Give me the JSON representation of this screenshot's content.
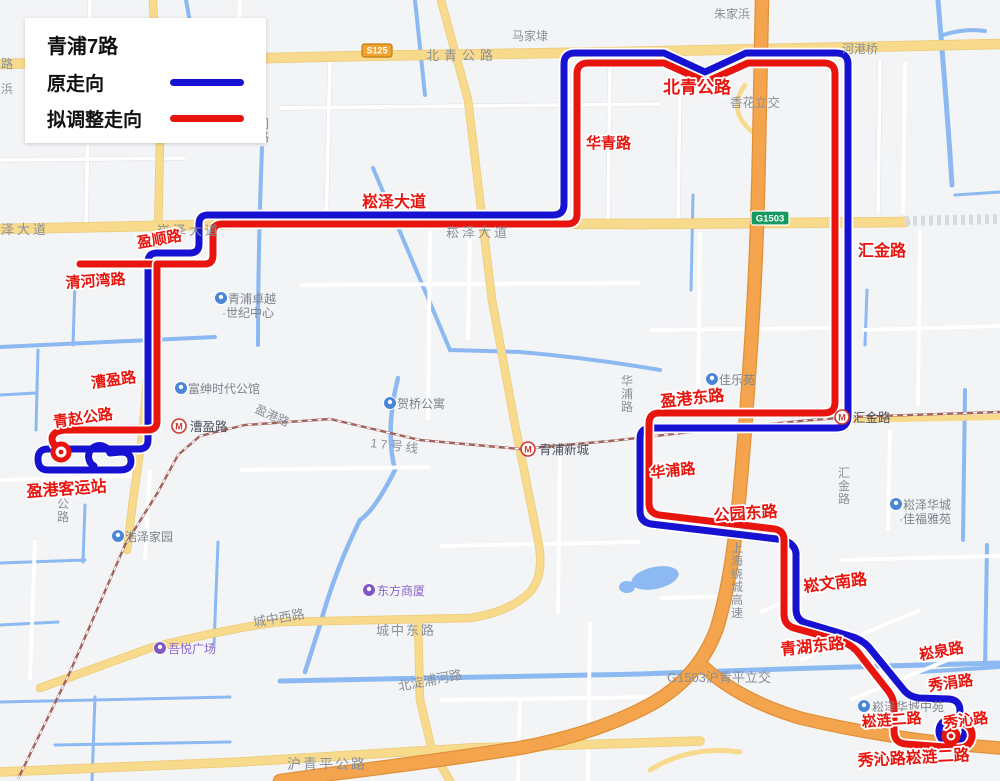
{
  "legend": {
    "title": "青浦7路",
    "items": [
      {
        "label": "原走向",
        "color": "#1712d2"
      },
      {
        "label": "拟调整走向",
        "color": "#e8150f"
      }
    ]
  },
  "routes": {
    "original": {
      "name": "原走向",
      "color": "#1712d2",
      "path": "M 94 466 A 11 11 0 1 1 110 453 L 121 452 Q 131 452 131 461 Q 131 470 120 470 L 48 470 Q 38 470 38 459 Q 38 449 48 449 L 139 449 Q 148 449 148 440 L 148 262 Q 148 253 157 253 L 190 253 Q 199 253 199 244 L 199 224 Q 199 215 208 215 L 553 215 Q 564 215 564 204 L 564 64 Q 564 53 575 53 L 664 53 L 705 72 L 746 53 L 836 53 Q 848 53 848 64 L 848 416 Q 848 428 836 428 L 651 428 Q 640 428 640 439 L 640 511 Q 640 522 651 524 L 777 539 Q 794 541 796 553 L 796 609 Q 796 620 806 623 L 853 637 Q 865 641 872 651 L 903 689 Q 909 697 919 698 L 949 699 Q 960 700 960 711 L 960 721 A 13 13 0 1 1 944 721"
    },
    "adjusted": {
      "name": "拟调整走向",
      "color": "#e8150f",
      "spur": "M 80 264 L 210 264",
      "path": "M 55 446 Q 49 438 55 433 Q 59 430 67 430 L 148 430 Q 157 430 157 421 L 157 264 L 205 264 Q 213 264 213 255 L 213 233 Q 213 224 222 224 L 567 224 Q 577 224 577 214 L 577 74 Q 577 63 588 63 L 664 63 L 706 82 L 748 63 L 824 63 Q 835 63 835 74 L 835 402 Q 835 413 824 413 L 659 413 Q 649 413 649 424 L 649 503 Q 649 513 659 515 L 775 529 Q 784 531 784 540 L 784 614 Q 784 625 794 628 L 841 641 Q 853 645 860 655 L 889 692 Q 894 699 894 707 L 894 731 Q 894 743 906 744 L 958 748 Q 970 748 972 737 Q 973 727 963 723"
    }
  },
  "terminals": {
    "southwest": {
      "cx": 61,
      "cy": 452,
      "r": 8
    },
    "southeast": {
      "cx": 951,
      "cy": 736,
      "r": 7
    }
  },
  "route_labels": [
    {
      "text": "北青公路",
      "x": 663,
      "y": 93,
      "size": 17,
      "rotate": 0
    },
    {
      "text": "华青路",
      "x": 586,
      "y": 148,
      "size": 15,
      "rotate": 0
    },
    {
      "text": "崧泽大道",
      "x": 362,
      "y": 207,
      "size": 16,
      "rotate": 0
    },
    {
      "text": "汇金路",
      "x": 858,
      "y": 256,
      "size": 16,
      "rotate": 0
    },
    {
      "text": "盈顺路",
      "x": 138,
      "y": 248,
      "size": 15,
      "rotate": -10
    },
    {
      "text": "清河湾路",
      "x": 66,
      "y": 288,
      "size": 15,
      "rotate": -4
    },
    {
      "text": "漕盈路",
      "x": 92,
      "y": 388,
      "size": 15,
      "rotate": -8
    },
    {
      "text": "青赵公路",
      "x": 54,
      "y": 427,
      "size": 15,
      "rotate": -8
    },
    {
      "text": "盈港客运站",
      "x": 27,
      "y": 497,
      "size": 16,
      "rotate": -4
    },
    {
      "text": "盈港东路",
      "x": 661,
      "y": 407,
      "size": 16,
      "rotate": -6
    },
    {
      "text": "华浦路",
      "x": 651,
      "y": 478,
      "size": 15,
      "rotate": -6
    },
    {
      "text": "公园东路",
      "x": 714,
      "y": 521,
      "size": 16,
      "rotate": -4
    },
    {
      "text": "崧文南路",
      "x": 804,
      "y": 592,
      "size": 16,
      "rotate": -7
    },
    {
      "text": "青湖东路",
      "x": 781,
      "y": 655,
      "size": 16,
      "rotate": -6
    },
    {
      "text": "崧泉路",
      "x": 920,
      "y": 660,
      "size": 15,
      "rotate": -10
    },
    {
      "text": "秀涓路",
      "x": 929,
      "y": 691,
      "size": 15,
      "rotate": -8
    },
    {
      "text": "崧涟二路",
      "x": 862,
      "y": 727,
      "size": 15,
      "rotate": -4
    },
    {
      "text": "秀沁路",
      "x": 944,
      "y": 728,
      "size": 15,
      "rotate": -7
    },
    {
      "text": "秀沁路崧涟二路",
      "x": 858,
      "y": 766,
      "size": 16,
      "rotate": -3
    }
  ],
  "map_labels": [
    {
      "text": "路",
      "x": 1,
      "y": 68,
      "size": 12
    },
    {
      "text": "浜",
      "x": 1,
      "y": 93,
      "size": 12
    },
    {
      "text": "朱家浜",
      "x": 714,
      "y": 18,
      "size": 12
    },
    {
      "text": "马家埭",
      "x": 512,
      "y": 40,
      "size": 12
    },
    {
      "text": "河港桥",
      "x": 842,
      "y": 53,
      "size": 12
    },
    {
      "text": "北青公路",
      "x": 426,
      "y": 60,
      "size": 13,
      "spacing": 5
    },
    {
      "text": "香花立交",
      "x": 730,
      "y": 107,
      "size": 12.5
    },
    {
      "text": "泽大道",
      "x": 1,
      "y": 234,
      "size": 13,
      "spacing": 3
    },
    {
      "text": "崧泽大道",
      "x": 157,
      "y": 235,
      "size": 13,
      "spacing": 3
    },
    {
      "text": "崧泽大道",
      "x": 446,
      "y": 237,
      "size": 13,
      "spacing": 3
    },
    {
      "text": "门路",
      "x": 257,
      "y": 128,
      "size": 12,
      "vertical": true
    },
    {
      "text": "盈港路",
      "x": 254,
      "y": 412,
      "size": 12,
      "rotate": 24
    },
    {
      "text": "17号线",
      "x": 370,
      "y": 447,
      "size": 12.5,
      "rotate": 7,
      "color": "#9b6157",
      "spacing": 3
    },
    {
      "text": "华浦路",
      "x": 621,
      "y": 385,
      "size": 12,
      "vertical": true
    },
    {
      "text": "汇金路",
      "x": 838,
      "y": 477,
      "size": 12,
      "vertical": true
    },
    {
      "text": "上海绕城高速",
      "x": 731,
      "y": 552,
      "size": 12,
      "vertical": true
    },
    {
      "text": "G1503沪青平立交",
      "x": 667,
      "y": 682,
      "size": 13
    },
    {
      "text": "城中西路",
      "x": 254,
      "y": 627,
      "size": 13,
      "rotate": -10
    },
    {
      "text": "城中东路",
      "x": 376,
      "y": 635,
      "size": 13,
      "spacing": 2
    },
    {
      "text": "北淀浦河路",
      "x": 399,
      "y": 691,
      "size": 13,
      "rotate": -11
    },
    {
      "text": "沪青平公路",
      "x": 287,
      "y": 769,
      "size": 14,
      "spacing": 2
    },
    {
      "text": "公路",
      "x": 57,
      "y": 508,
      "size": 12,
      "vertical": true
    }
  ],
  "pois": [
    {
      "text": "青浦卓越",
      "x": 228,
      "y": 303,
      "cx": 221,
      "cy": 298,
      "kind": "blue",
      "line2": "·世纪中心",
      "l2x": 222,
      "l2y": 317
    },
    {
      "text": "富绅时代公馆",
      "x": 188,
      "y": 393,
      "cx": 181,
      "cy": 388,
      "kind": "blue"
    },
    {
      "text": "贺桥公寓",
      "x": 397,
      "y": 408,
      "cx": 390,
      "cy": 403,
      "kind": "blue"
    },
    {
      "text": "佳乐苑",
      "x": 719,
      "y": 384,
      "cx": 712,
      "cy": 379,
      "kind": "blue"
    },
    {
      "text": "崧泽华城",
      "x": 903,
      "y": 509,
      "cx": 896,
      "cy": 504,
      "kind": "blue",
      "line2": "·佳福雅苑",
      "l2x": 899,
      "l2y": 523
    },
    {
      "text": "浩泽家园",
      "x": 125,
      "y": 541,
      "cx": 118,
      "cy": 536,
      "kind": "blue"
    },
    {
      "text": "崧泽华城中苑",
      "x": 872,
      "y": 711,
      "cx": 864,
      "cy": 706,
      "kind": "blue"
    },
    {
      "text": "东方商厦",
      "x": 377,
      "y": 595,
      "cx": 369,
      "cy": 590,
      "kind": "purple"
    },
    {
      "text": "吾悦广场",
      "x": 168,
      "y": 653,
      "cx": 160,
      "cy": 648,
      "kind": "purple"
    }
  ],
  "stations": [
    {
      "name": "漕盈路",
      "x": 190,
      "y": 431,
      "cx": 179,
      "cy": 426
    },
    {
      "name": "青浦新城",
      "x": 539,
      "y": 454,
      "cx": 528,
      "cy": 449
    },
    {
      "name": "汇金路",
      "x": 853,
      "y": 422,
      "cx": 842,
      "cy": 417
    }
  ],
  "badges": [
    {
      "text": "S125",
      "kind": "provincial",
      "x": 362,
      "y": 44,
      "w": 30,
      "h": 13
    },
    {
      "text": "G1503",
      "kind": "expressway",
      "x": 751,
      "y": 211,
      "w": 38,
      "h": 14
    }
  ],
  "icon_colors": {
    "poi_blue": "#4a86d8",
    "poi_purple": "#8057c8",
    "metro": "#d03a32"
  }
}
